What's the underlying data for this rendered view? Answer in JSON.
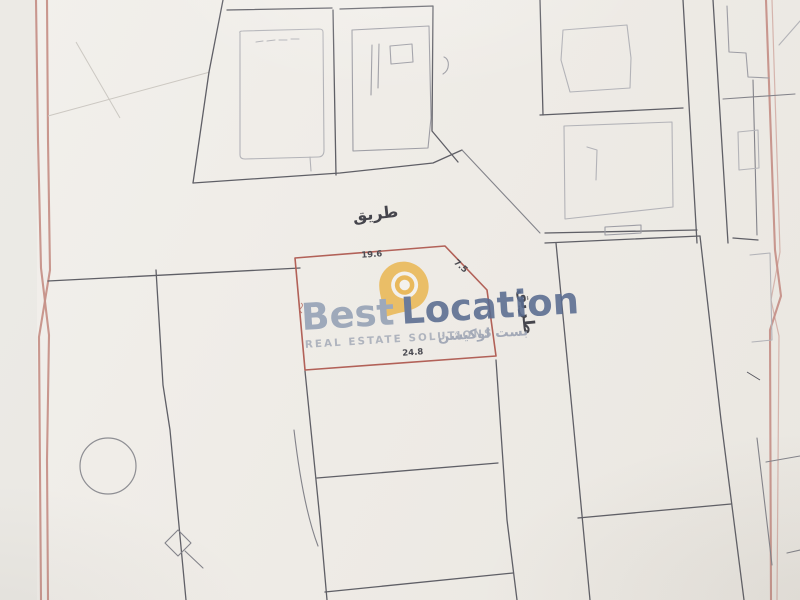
{
  "plan": {
    "road_label_top": "طريق",
    "road_label_right": "طريق",
    "highlight_plot": {
      "dim_top": "19.6",
      "dim_bottom": "24.8",
      "dim_corner": "7.5"
    }
  },
  "watermark": {
    "brand_first": "Best",
    "brand_second": "Location",
    "tagline": "REAL ESTATE SOLUTIONS",
    "tagline_ar": "بست لوكيشن"
  },
  "colors": {
    "border_pink": "#c69189",
    "plot_line": "#5f5f66",
    "building_line": "#b3b3b8",
    "highlight_red": "#b26158",
    "label_gray": "#4b4b52",
    "brand_light": "#93a0b5",
    "brand_dark": "#5a6c90",
    "brand_amber": "#e9b34a",
    "tagline_gray": "#a7adb9"
  }
}
